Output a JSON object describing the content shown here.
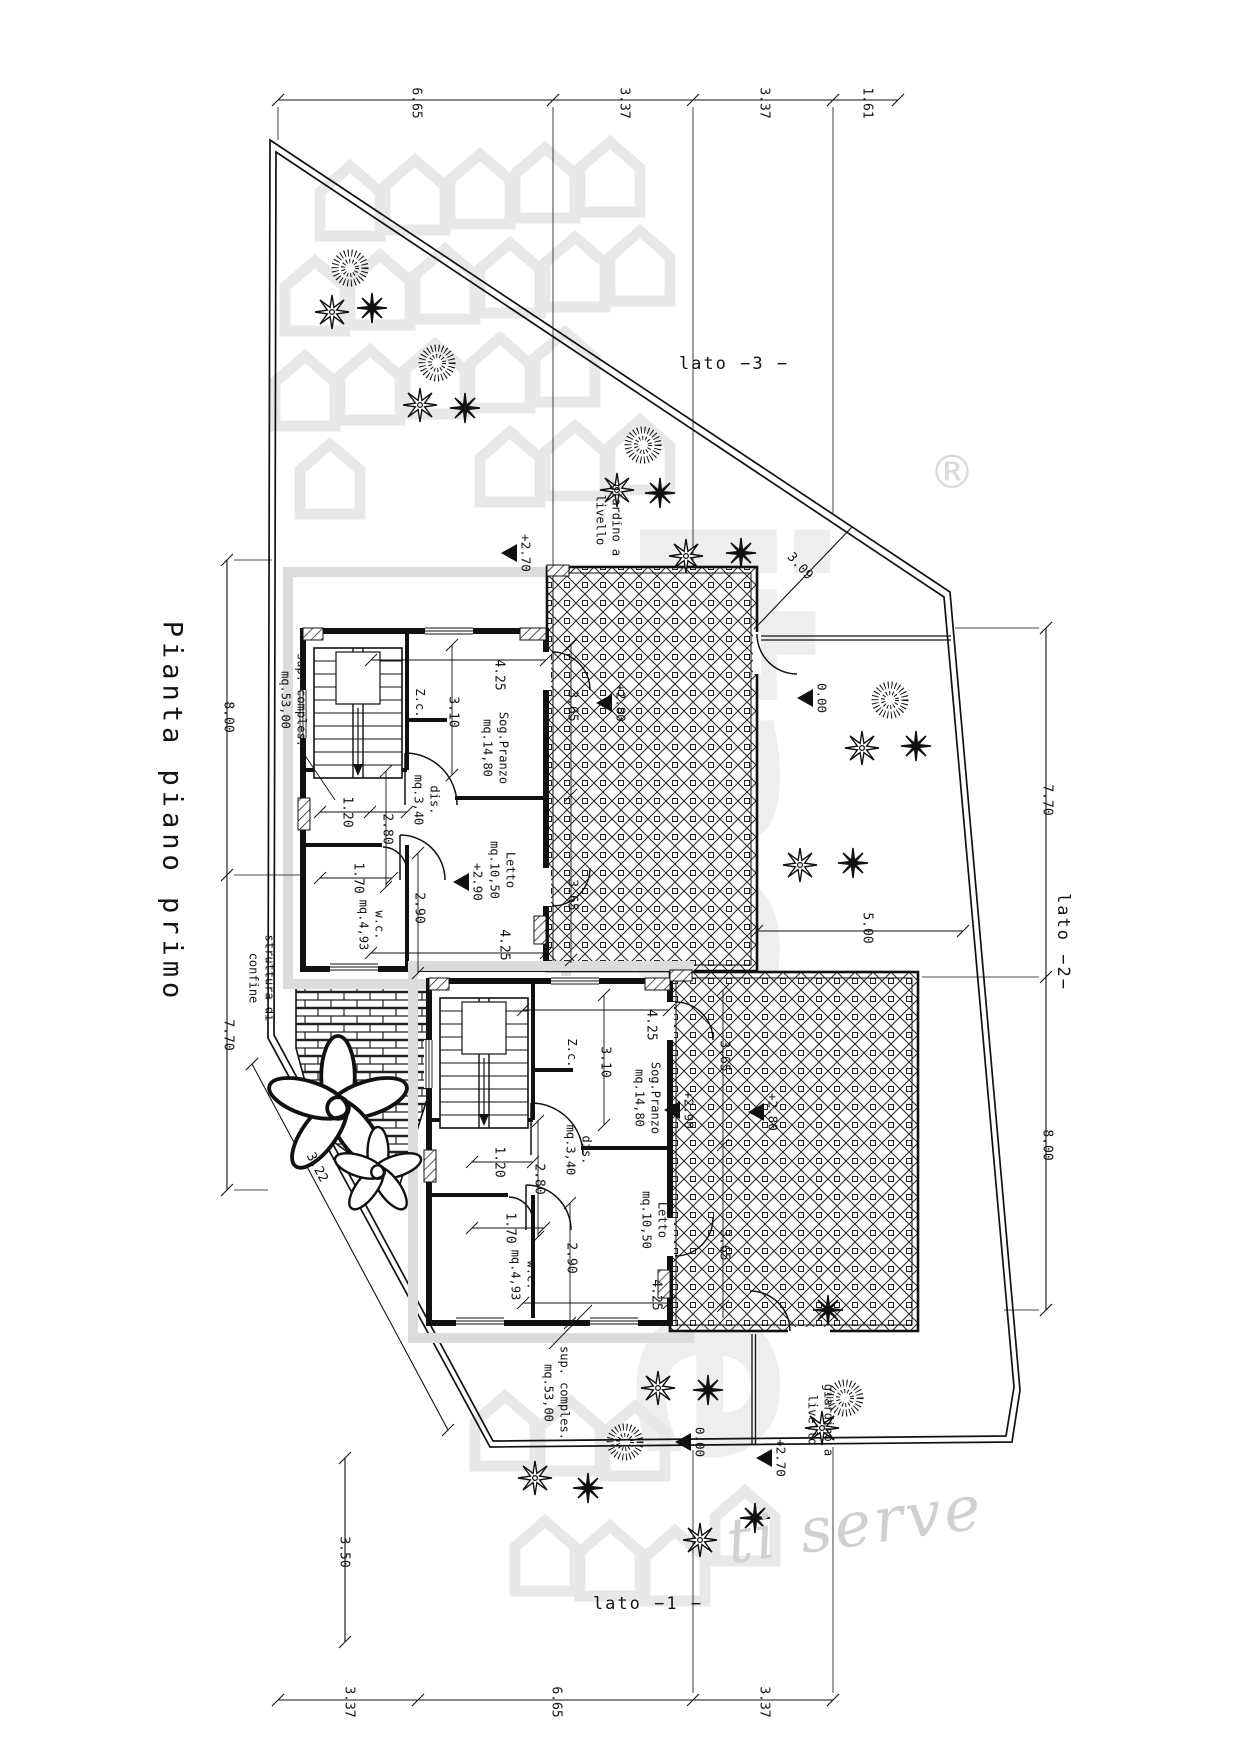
{
  "drawing": {
    "title": "Pianta piano primo",
    "side_labels": {
      "side1": "lato  −1 −",
      "side2": "lato  −2−",
      "side3": "lato  −3  −"
    },
    "watermark": {
      "brand": "itacase",
      "registered_mark": "®",
      "tagline": "ti serve"
    },
    "dimension_labels": [
      {
        "text": "6.65",
        "x": 415,
        "y": 103,
        "rot": 90
      },
      {
        "text": "3.37",
        "x": 623,
        "y": 103,
        "rot": 90
      },
      {
        "text": "3.37",
        "x": 763,
        "y": 103,
        "rot": 90
      },
      {
        "text": "1.61",
        "x": 866,
        "y": 103,
        "rot": 90
      },
      {
        "text": "3.37",
        "x": 348,
        "y": 1702,
        "rot": 90
      },
      {
        "text": "6.65",
        "x": 555,
        "y": 1702,
        "rot": 90
      },
      {
        "text": "3.37",
        "x": 763,
        "y": 1702,
        "rot": 90
      },
      {
        "text": "3.50",
        "x": 343,
        "y": 1552,
        "rot": 90
      },
      {
        "text": "8.00",
        "x": 227,
        "y": 717,
        "rot": 90
      },
      {
        "text": "7.70",
        "x": 227,
        "y": 1035,
        "rot": 90
      },
      {
        "text": "7.70",
        "x": 1046,
        "y": 800,
        "rot": 90
      },
      {
        "text": "8.00",
        "x": 1046,
        "y": 1145,
        "rot": 90
      },
      {
        "text": "5.00",
        "x": 866,
        "y": 928,
        "rot": 90
      },
      {
        "text": "3.09",
        "x": 799,
        "y": 567,
        "rot": 48
      },
      {
        "text": "3.22",
        "x": 316,
        "y": 1168,
        "rot": 62
      },
      {
        "text": "4.25",
        "x": 498,
        "y": 675,
        "rot": 90
      },
      {
        "text": "3.10",
        "x": 452,
        "y": 712,
        "rot": 90
      },
      {
        "text": "3.65",
        "x": 571,
        "y": 706,
        "rot": 90
      },
      {
        "text": "1.20",
        "x": 346,
        "y": 812,
        "rot": 90
      },
      {
        "text": "2.80",
        "x": 386,
        "y": 829,
        "rot": 90
      },
      {
        "text": "1.70",
        "x": 357,
        "y": 878,
        "rot": 90
      },
      {
        "text": "2.90",
        "x": 418,
        "y": 908,
        "rot": 90
      },
      {
        "text": "4.25",
        "x": 503,
        "y": 945,
        "rot": 90
      },
      {
        "text": "3.65",
        "x": 571,
        "y": 895,
        "rot": 90
      },
      {
        "text": "4.25",
        "x": 650,
        "y": 1025,
        "rot": 90
      },
      {
        "text": "3.10",
        "x": 604,
        "y": 1062,
        "rot": 90
      },
      {
        "text": "3.65",
        "x": 723,
        "y": 1056,
        "rot": 90
      },
      {
        "text": "1.20",
        "x": 498,
        "y": 1162,
        "rot": 90
      },
      {
        "text": "2.80",
        "x": 538,
        "y": 1179,
        "rot": 90
      },
      {
        "text": "1.70",
        "x": 509,
        "y": 1228,
        "rot": 90
      },
      {
        "text": "2.90",
        "x": 570,
        "y": 1258,
        "rot": 90
      },
      {
        "text": "4.25",
        "x": 655,
        "y": 1295,
        "rot": 90
      },
      {
        "text": "3.65",
        "x": 723,
        "y": 1245,
        "rot": 90
      }
    ],
    "room_labels": [
      {
        "text": "Z.c.",
        "x": 419,
        "y": 703,
        "rot": 90
      },
      {
        "text": "Sog.Pranzo\nmq.14,80",
        "x": 495,
        "y": 748,
        "rot": 90
      },
      {
        "text": "dis.\nmq.3,40",
        "x": 426,
        "y": 800,
        "rot": 90
      },
      {
        "text": "w.c.\nmq.4,93",
        "x": 371,
        "y": 925,
        "rot": 90
      },
      {
        "text": "Letto\nmq.10,50",
        "x": 502,
        "y": 870,
        "rot": 90
      },
      {
        "text": "Z.c.",
        "x": 571,
        "y": 1053,
        "rot": 90
      },
      {
        "text": "Sog.Pranzo\nmq.14,80",
        "x": 647,
        "y": 1098,
        "rot": 90
      },
      {
        "text": "dis.\nmq.3,40",
        "x": 578,
        "y": 1150,
        "rot": 90
      },
      {
        "text": "w.c.\nmq.4,93",
        "x": 523,
        "y": 1275,
        "rot": 90
      },
      {
        "text": "Letto\nmq.10,50",
        "x": 654,
        "y": 1220,
        "rot": 90
      }
    ],
    "annotation_labels": [
      {
        "text": "sup. comples.\nmq.53,00",
        "x": 293,
        "y": 700,
        "rot": 90
      },
      {
        "text": "sup. comples.\nmq.53,00",
        "x": 556,
        "y": 1393,
        "rot": 90
      },
      {
        "text": "giardino a\nlivello",
        "x": 608,
        "y": 520,
        "rot": 90
      },
      {
        "text": "giardino a\nlivello",
        "x": 820,
        "y": 1420,
        "rot": 90
      },
      {
        "text": "struttura di\nconfine",
        "x": 261,
        "y": 978,
        "rot": 90
      }
    ],
    "level_markers": [
      {
        "label": "+2.70",
        "x": 510,
        "y": 553
      },
      {
        "label": "+2.80",
        "x": 605,
        "y": 703
      },
      {
        "label": "+2.90",
        "x": 462,
        "y": 882
      },
      {
        "label": "0.00",
        "x": 806,
        "y": 698
      },
      {
        "label": "+2.90",
        "x": 673,
        "y": 1110
      },
      {
        "label": "+2.80",
        "x": 757,
        "y": 1112
      },
      {
        "label": "0.00",
        "x": 684,
        "y": 1442
      },
      {
        "label": "+2.70",
        "x": 765,
        "y": 1458
      }
    ],
    "plants": [
      {
        "t": "bush",
        "x": 350,
        "y": 268
      },
      {
        "t": "flower",
        "x": 332,
        "y": 312
      },
      {
        "t": "star",
        "x": 372,
        "y": 308
      },
      {
        "t": "bush",
        "x": 437,
        "y": 363
      },
      {
        "t": "flower",
        "x": 420,
        "y": 405
      },
      {
        "t": "star",
        "x": 465,
        "y": 408
      },
      {
        "t": "bush",
        "x": 643,
        "y": 445
      },
      {
        "t": "flower",
        "x": 617,
        "y": 490
      },
      {
        "t": "star",
        "x": 660,
        "y": 493
      },
      {
        "t": "flower",
        "x": 686,
        "y": 556
      },
      {
        "t": "star",
        "x": 741,
        "y": 553
      },
      {
        "t": "bush",
        "x": 890,
        "y": 700
      },
      {
        "t": "flower",
        "x": 862,
        "y": 748
      },
      {
        "t": "star",
        "x": 916,
        "y": 746
      },
      {
        "t": "flower",
        "x": 800,
        "y": 865
      },
      {
        "t": "star",
        "x": 853,
        "y": 863
      },
      {
        "t": "flower",
        "x": 658,
        "y": 1388
      },
      {
        "t": "star",
        "x": 708,
        "y": 1390
      },
      {
        "t": "bush",
        "x": 625,
        "y": 1442
      },
      {
        "t": "flower",
        "x": 535,
        "y": 1478
      },
      {
        "t": "star",
        "x": 588,
        "y": 1488
      },
      {
        "t": "bush",
        "x": 845,
        "y": 1398
      },
      {
        "t": "star",
        "x": 828,
        "y": 1310
      },
      {
        "t": "flower",
        "x": 822,
        "y": 1428
      },
      {
        "t": "flower",
        "x": 700,
        "y": 1540
      },
      {
        "t": "star",
        "x": 755,
        "y": 1518
      },
      {
        "t": "bigflower",
        "x": 338,
        "y": 1108,
        "s": 2.4
      },
      {
        "t": "bigflower",
        "x": 378,
        "y": 1172,
        "s": 1.5
      }
    ]
  }
}
